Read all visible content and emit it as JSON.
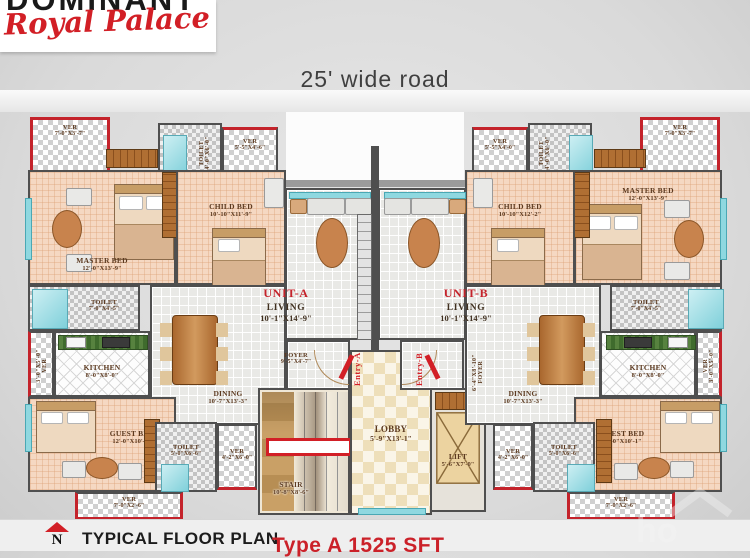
{
  "header": {
    "brand": "DOMINANT",
    "brand_script": "Royal Palace",
    "road": "25' wide road"
  },
  "core": {
    "stair": {
      "name": "STAIR",
      "dim": "10'-8\"X8'-6\""
    },
    "lobby": {
      "name": "LOBBY",
      "dim": "5'-9\"X13'-1\""
    },
    "lift": {
      "name": "LIFT",
      "dim": "5'-6\"X7'-0\""
    }
  },
  "unit_a": {
    "label": "UNIT-A",
    "entry": "Entry-A",
    "living": {
      "name": "LIVING",
      "dim": "10'-1\"X14'-9\""
    },
    "foyer": {
      "name": "FOYER",
      "dim": "9'-5\"X4'-7\""
    },
    "dining": {
      "name": "DINING",
      "dim": "10'-7\"X13'-3\""
    },
    "kitchen": {
      "name": "KITCHEN",
      "dim": "8'-0\"X8'-0\""
    },
    "master": {
      "name": "MASTER BED",
      "dim": "12'-0\"X13'-9\""
    },
    "child": {
      "name": "CHILD BED",
      "dim": "10'-10\"X11'-9\""
    },
    "guest": {
      "name": "GUEST BED",
      "dim": "12'-0\"X10'-1\""
    },
    "toilet_top": {
      "name": "TOILET",
      "dim": "4'-0\"X6'-0\""
    },
    "toilet_mid": {
      "name": "TOILET",
      "dim": "7'-0\"X4'-5\""
    },
    "toilet_bot": {
      "name": "TOILET",
      "dim": "5'-0\"X6'-6\""
    },
    "ver_top": {
      "name": "VER",
      "dim": "7'-0\"X3'-7\""
    },
    "ver_top2": {
      "name": "VER",
      "dim": "5'-5\"X4'-6\""
    },
    "ver_side": {
      "name": "VER",
      "dim": "3'-0\"X5'-0\""
    },
    "ver_mid_bot": {
      "name": "VER",
      "dim": "4'-2\"X6'-0\""
    },
    "ver_bottom": {
      "name": "VER",
      "dim": "7'-0\"X2'-6\""
    }
  },
  "unit_b": {
    "label": "UNIT-B",
    "entry": "Entry-B",
    "living": {
      "name": "LIVING",
      "dim": "10'-1\"X14'-9\""
    },
    "foyer": {
      "name": "FOYER",
      "dim": "6'-4\"X8'-10\""
    },
    "dining": {
      "name": "DINING",
      "dim": "10'-7\"X13'-3\""
    },
    "kitchen": {
      "name": "KITCHEN",
      "dim": "8'-0\"X8'-0\""
    },
    "master": {
      "name": "MASTER BED",
      "dim": "12'-0\"X13'-9\""
    },
    "child": {
      "name": "CHILD BED",
      "dim": "10'-10\"X12'-2\""
    },
    "guest": {
      "name": "GUEST BED",
      "dim": "12'-0\"X10'-1\""
    },
    "toilet_top": {
      "name": "TOILET",
      "dim": "4'-0\"X6'-0\""
    },
    "toilet_mid": {
      "name": "TOILET",
      "dim": "7'-0\"X4'-5\""
    },
    "toilet_bot": {
      "name": "TOILET",
      "dim": "5'-0\"X6'-6\""
    },
    "ver_top": {
      "name": "VER",
      "dim": "7'-0\"X3'-7\""
    },
    "ver_top2": {
      "name": "VER",
      "dim": "5'-5\"X4'-0\""
    },
    "ver_side": {
      "name": "VER",
      "dim": "3'-0\"X5'-0\""
    },
    "ver_mid_bot": {
      "name": "VER",
      "dim": "4'-2\"X6'-0\""
    },
    "ver_bottom": {
      "name": "VER",
      "dim": "7'-0\"X2'-6\""
    }
  },
  "footer": {
    "north_letter": "N",
    "title": "TYPICAL FLOOR PLAN",
    "plan_type": "Type A 1525 SFT",
    "watermark": "ho"
  },
  "colors": {
    "accent_red": "#c4232b",
    "wall_gray": "#4f4f4f",
    "room_peach": "#f5d8c2",
    "window_aqua": "#8fd8e0"
  }
}
